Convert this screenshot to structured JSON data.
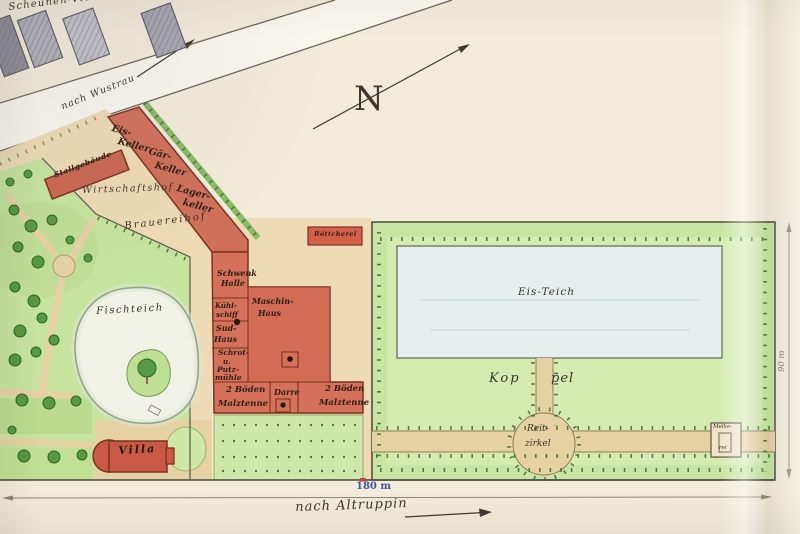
{
  "labels": {
    "scheunen_viertel": "Scheunen-Viertel",
    "nach_wustrau": "nach Wustrau",
    "north": "N",
    "stallgebaeude": "Stallgebäude",
    "eis_keller_1": "Eis-",
    "eis_keller_2": "Keller",
    "gaer_keller_1": "Gär-",
    "gaer_keller_2": "Keller",
    "lager_keller_1": "Lager-",
    "lager_keller_2": "keller",
    "wirtschaftshof": "Wirtschaftshof",
    "brauereihof": "Brauereihof",
    "boettcherei": "Böttcherei",
    "schwenk_halle_1": "Schwenk",
    "schwenk_halle_2": "Halle",
    "maschinen_haus_1": "Maschin-",
    "maschinen_haus_2": "Haus",
    "kuehlschiff_1": "Kühl-",
    "kuehlschiff_2": "schiff",
    "sudhaus_1": "Sud-",
    "sudhaus_2": "Haus",
    "schrot_1": "Schrot-",
    "schrot_2": "u.",
    "schrot_3": "Putz-",
    "schrot_4": "mühle",
    "malztenne_left_1": "2 Böden",
    "malztenne_left_2": "Malztenne",
    "darre": "Darre",
    "malztenne_right_1": "2 Böden",
    "malztenne_right_2": "Malztenne",
    "fischteich": "Fischteich",
    "villa": "Villa",
    "eis_teich": "Eis-Teich",
    "koppel_1": "Kop",
    "koppel_2": "pel",
    "reitzirkel_1": "Reit-",
    "reitzirkel_2": "zirkel",
    "melkerei_1": "Melke-",
    "melkerei_2": "rei",
    "dim_bottom": "180 m",
    "dim_right": "90 m",
    "nach_altruppin": "nach Altruppin"
  },
  "colors": {
    "paper": "#f3ecdb",
    "courtyard_tan": "#eedbb5",
    "path_tan": "#e6d1a3",
    "building_red": "#d0705a",
    "building_stroke": "#7b3322",
    "park_green": "#c6e49e",
    "koppel_green": "#c9e5a2",
    "hedge_green": "#8abb66",
    "pond_pale": "#f1f3e9",
    "ice_pond_blue": "#e6efee",
    "barn_gray": "#b2b1b9",
    "ink": "#3a332a",
    "dim_blue": "#3d55a2"
  }
}
